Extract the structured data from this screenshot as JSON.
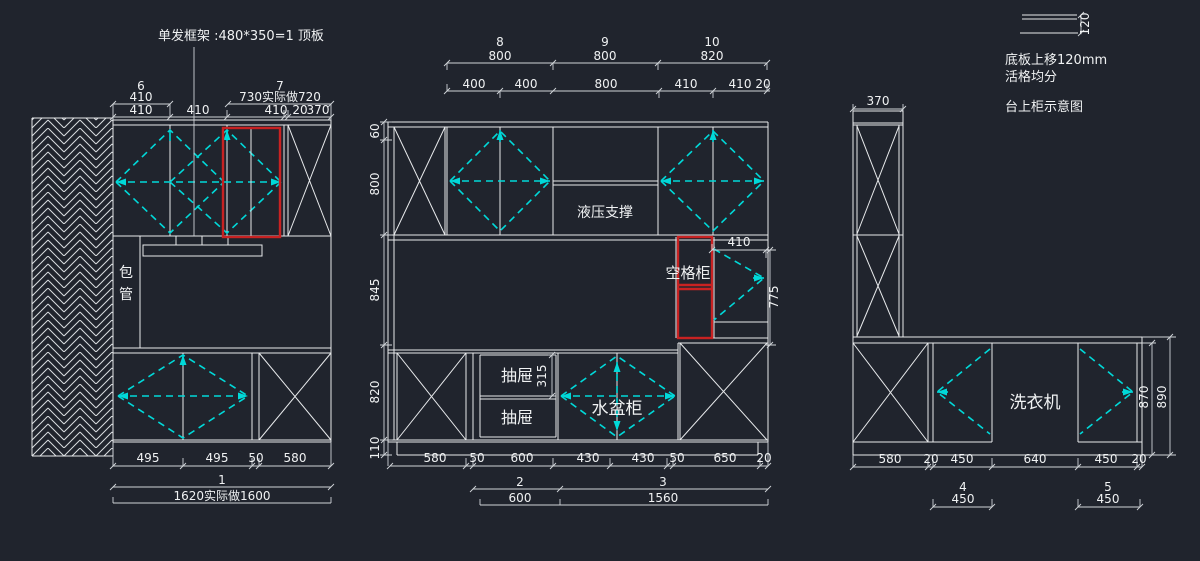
{
  "colors": {
    "background": "#20242d",
    "line": "#e8eaec",
    "door_swing": "#00d9d9",
    "highlight": "#c82222",
    "text": "#f0f2f3"
  },
  "annotations": {
    "frame_note": "单发框架 :480*350=1 顶板",
    "detail_dim": "120",
    "notes": [
      "底板上移120mm",
      "活格均分",
      "台上柜示意图"
    ]
  },
  "left": {
    "item6_no": "6",
    "item6_w": "410",
    "item7_no": "7",
    "item7_w": "730实际做720",
    "sub": [
      "410",
      "410",
      "410",
      "20",
      "370"
    ],
    "wall_1": "包",
    "wall_2": "管",
    "bottom": [
      "495",
      "495",
      "50",
      "580"
    ],
    "unit_no": "1",
    "total": "1620实际做1600"
  },
  "middle": {
    "items": [
      {
        "no": "8",
        "w": "800"
      },
      {
        "no": "9",
        "w": "800"
      },
      {
        "no": "10",
        "w": "820"
      }
    ],
    "sub": [
      "400",
      "400",
      "800",
      "410",
      "410",
      "20"
    ],
    "vdims": [
      "60",
      "800",
      "845",
      "820",
      "110"
    ],
    "hydraulic": "液压支撑",
    "empty_cab": "空格柜",
    "d410": "410",
    "d775": "775",
    "d315": "315",
    "drawer": "抽屉",
    "sink": "水盆柜",
    "bottom": [
      "580",
      "50",
      "600",
      "430",
      "430",
      "50",
      "650",
      "20"
    ],
    "unit2_no": "2",
    "unit2_w": "600",
    "unit3_no": "3",
    "unit3_w": "1560"
  },
  "right": {
    "d370": "370",
    "washer": "洗衣机",
    "d870": "870",
    "d890": "890",
    "bottom": [
      "580",
      "20",
      "450",
      "640",
      "450",
      "20"
    ],
    "unit4_no": "4",
    "unit4_w": "450",
    "unit5_no": "5",
    "unit5_w": "450"
  }
}
